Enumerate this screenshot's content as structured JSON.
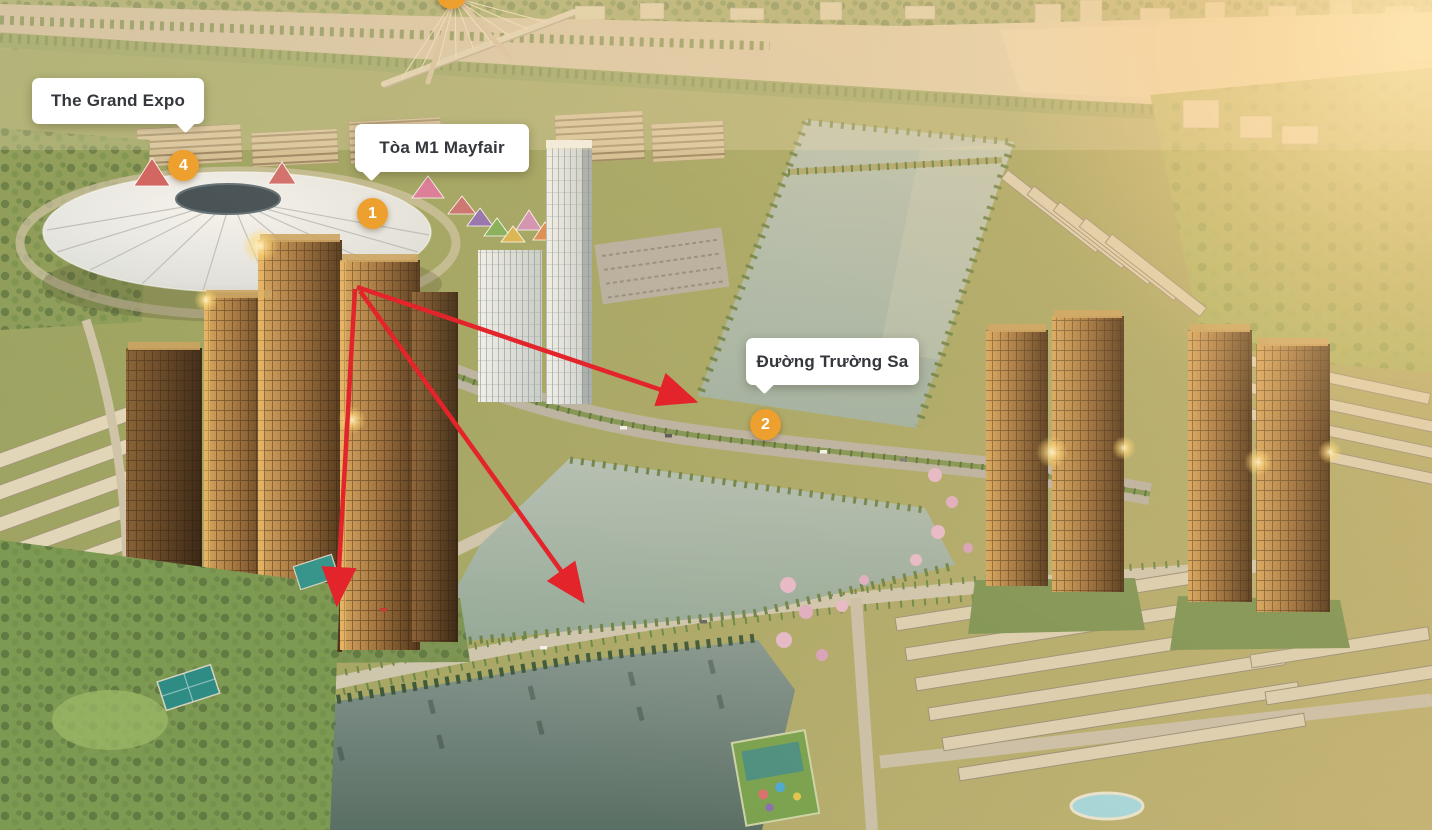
{
  "annotations": {
    "labels": [
      {
        "id": "the-grand-expo",
        "text": "The Grand Expo"
      },
      {
        "id": "toa-m1-mayfair",
        "text": "Tòa M1 Mayfair"
      },
      {
        "id": "duong-truong-sa",
        "text": "Đường Trường Sa"
      }
    ],
    "badges": [
      {
        "number": "4"
      },
      {
        "number": "1"
      },
      {
        "number": "2"
      },
      {
        "number": ""
      }
    ],
    "colors": {
      "badge_orange": "#EDA02E",
      "arrow_red": "#E3242B",
      "label_background": "#FFFFFF",
      "label_text": "#34373C"
    }
  }
}
